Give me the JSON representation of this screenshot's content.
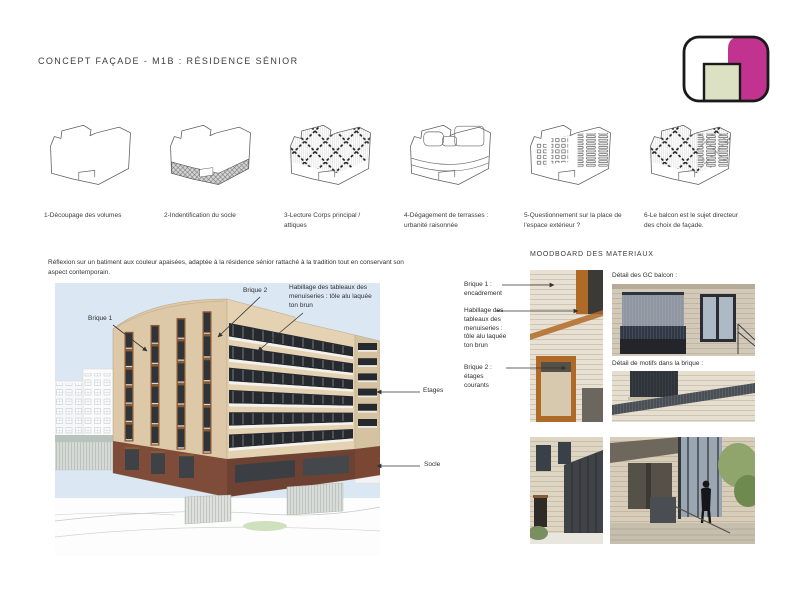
{
  "header": {
    "title": "CONCEPT FAÇADE - M1B : RÉSIDENCE SÉNIOR"
  },
  "steps": [
    {
      "label": "1-Découpage des volumes"
    },
    {
      "label": "2-Indentification du socle"
    },
    {
      "label": "3-Lecture Corps principal / attiques"
    },
    {
      "label": "4-Dégagement de terrasses : urbanité raisonnée"
    },
    {
      "label": "5-Questionnement sur la place de l'espace extérieur ?"
    },
    {
      "label": "6-Le balcon est le sujet directeur des choix de façade."
    }
  ],
  "concept_text": "Réflexion sur un batiment aux couleur apaisées, adaptée à la résidence sénior rattaché à la tradition tout en conservant son aspect contemporain.",
  "render_annotations": {
    "brique1": "Brique 1",
    "brique2": "Brique 2",
    "habillage": "Habillage des tableaux des menuiseries : tôle alu laquée ton brun",
    "etages": "Etages",
    "socle": "Socle"
  },
  "moodboard": {
    "title": "MOODBOARD DES MATERIAUX",
    "labels": {
      "brique1": "Brique 1 : encadrement",
      "habillage": "Habillage des tableaux des menuiseries : tôle alu laquée ton brun",
      "brique2": "Brique 2 : étages courants",
      "gc_balcon": "Détail des GC balcon :",
      "motifs": "Détail de motifs dans la brique :"
    }
  },
  "colors": {
    "facade_beige": "#ddc9a8",
    "socle_brown": "#7c4a37",
    "sky": "#dbe8f4",
    "frame_orange": "#b06a28",
    "logo_magenta": "#c23390",
    "logo_green": "#dbe1c2"
  }
}
